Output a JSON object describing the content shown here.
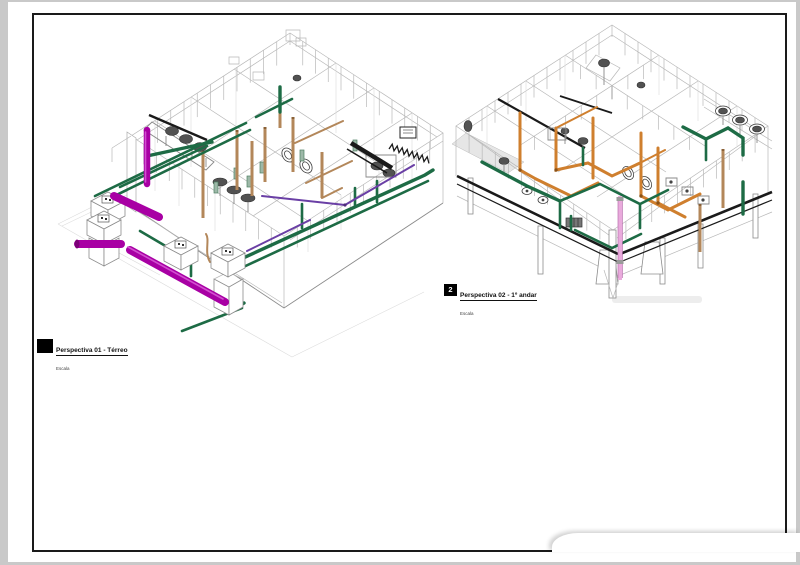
{
  "sheet": {
    "background": "#ffffff",
    "border_color": "#2b2b2b"
  },
  "views": [
    {
      "number_label": "",
      "title": "Perspectiva 01 - Térreo",
      "scale_label": "Escala"
    },
    {
      "number_label": "2",
      "title": "Perspectiva 02 - 1º andar",
      "scale_label": "Escala"
    }
  ],
  "legend_colors": {
    "sewage_magenta": "#a800a4",
    "drain_green": "#1d6b45",
    "vent_purple": "#6a3fa5",
    "water_orange": "#cf7f2e",
    "pipe_tan": "#b3875a",
    "recalque_pink": "#e9aadc",
    "wireframe_gray": "#b8b8b8",
    "structure_black": "#1a1a1a"
  }
}
